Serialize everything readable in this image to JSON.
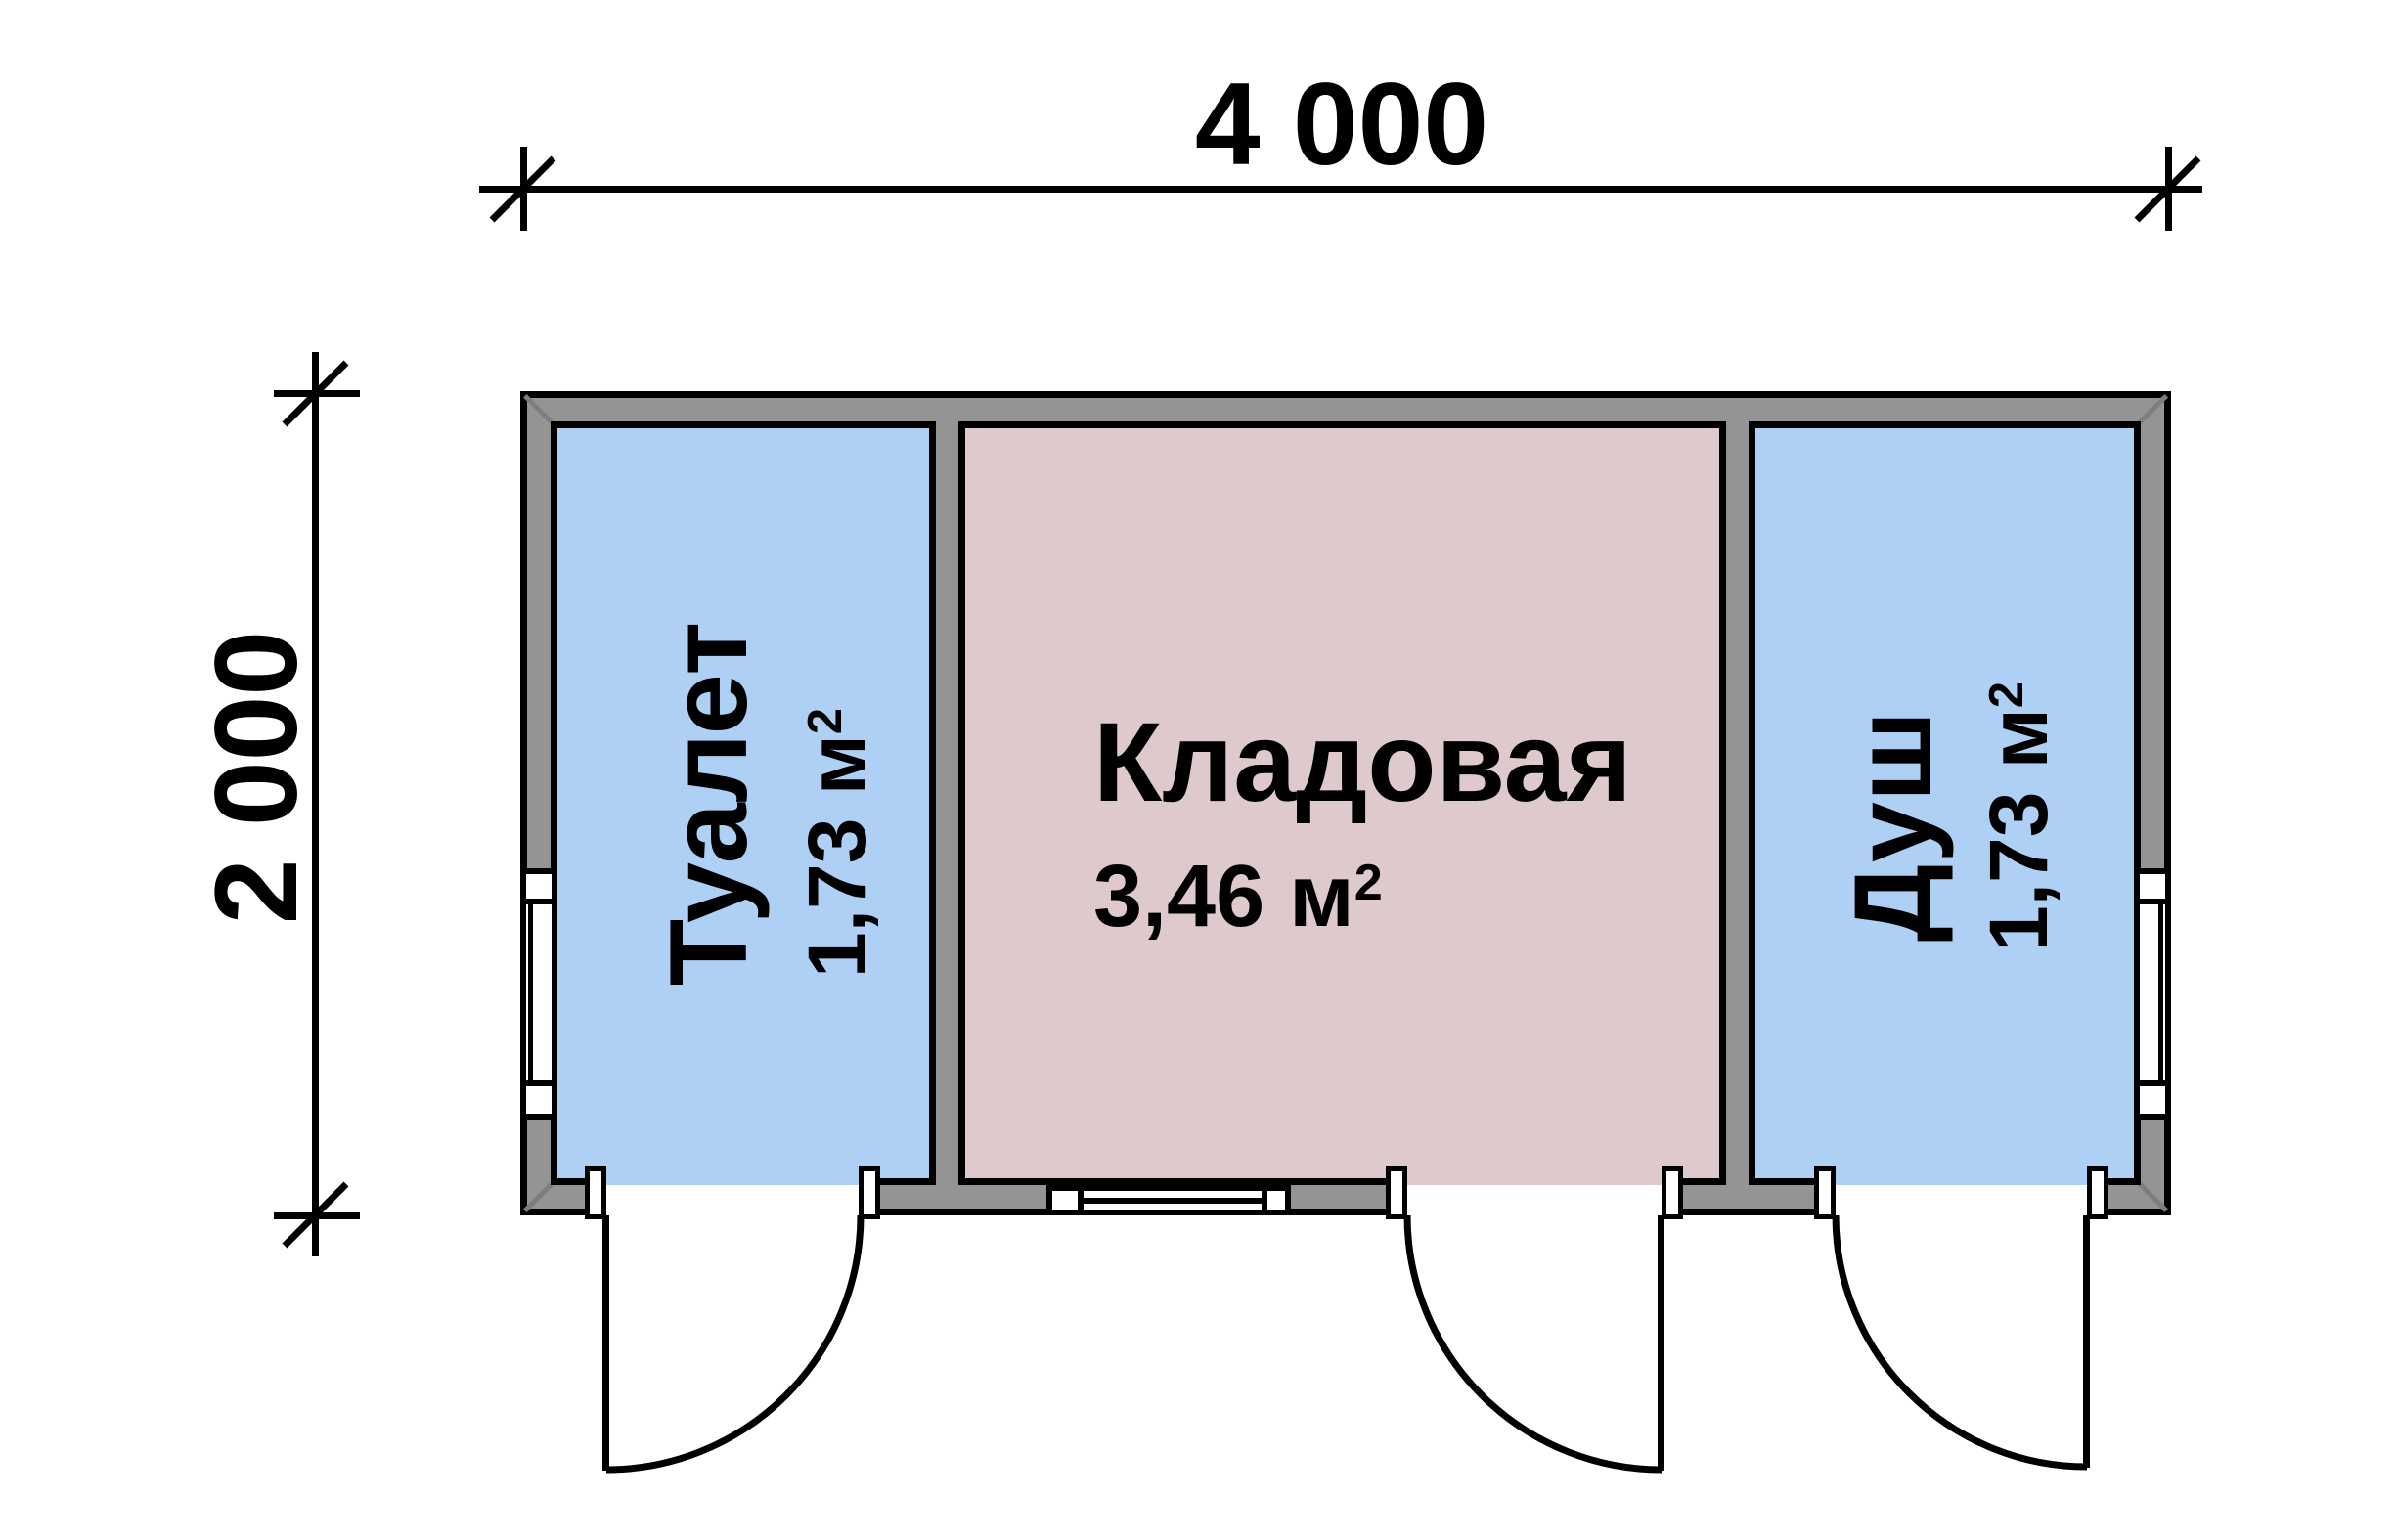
{
  "plan": {
    "type": "floor-plan",
    "dimensions": {
      "width_label": "4 000",
      "height_label": "2 000"
    },
    "rooms": [
      {
        "name": "Туалет",
        "area": "1,73 м",
        "area_sup": "2",
        "fill": "#aed0f5"
      },
      {
        "name": "Кладовая",
        "area": "3,46 м",
        "area_sup": "2",
        "fill": "#decacd"
      },
      {
        "name": "Душ",
        "area": "1,73 м",
        "area_sup": "2",
        "fill": "#aed0f5"
      }
    ],
    "colors": {
      "wall_fill": "#949494",
      "outline": "#000000",
      "wet_room_fill": "#aed0f5",
      "storage_fill": "#decacd",
      "background": "#ffffff"
    },
    "features": {
      "doors": 3,
      "windows": 3
    }
  }
}
